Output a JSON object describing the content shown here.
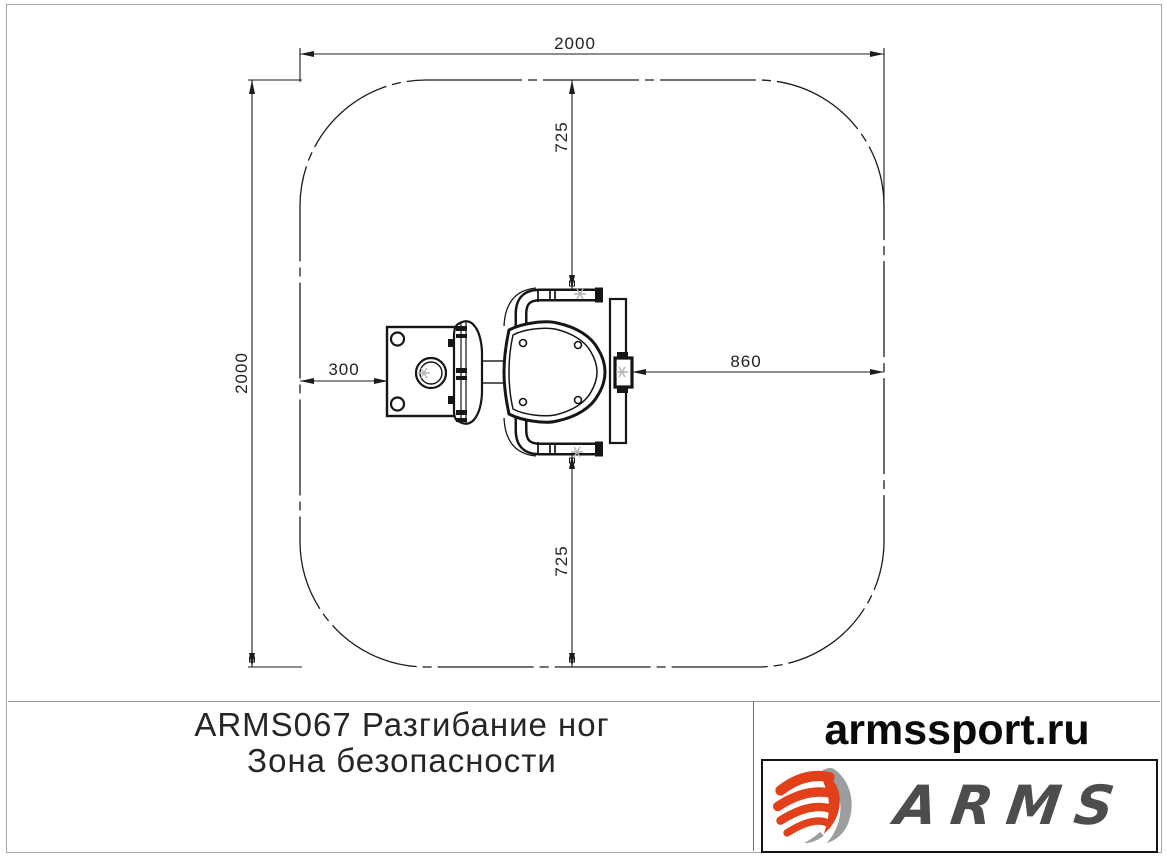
{
  "drawing": {
    "title_hint": "safety zone plan view",
    "zone": {
      "width_mm": 2000,
      "height_mm": 2000
    },
    "dimensions": {
      "top_width": "2000",
      "left_height": "2000",
      "top_offset": "725",
      "bottom_offset": "725",
      "left_offset": "300",
      "right_offset": "860"
    }
  },
  "footer": {
    "title_line1": "ARMS067 Разгибание ног",
    "title_line2": "Зона безопасности",
    "website": "armssport.ru",
    "logo_text": "ARMS"
  },
  "colors": {
    "line": "#1c1c1c",
    "logo_orange": "#e2401a",
    "logo_gray": "#9b9ea0",
    "logo_text_gray": "#4b4d4f"
  }
}
